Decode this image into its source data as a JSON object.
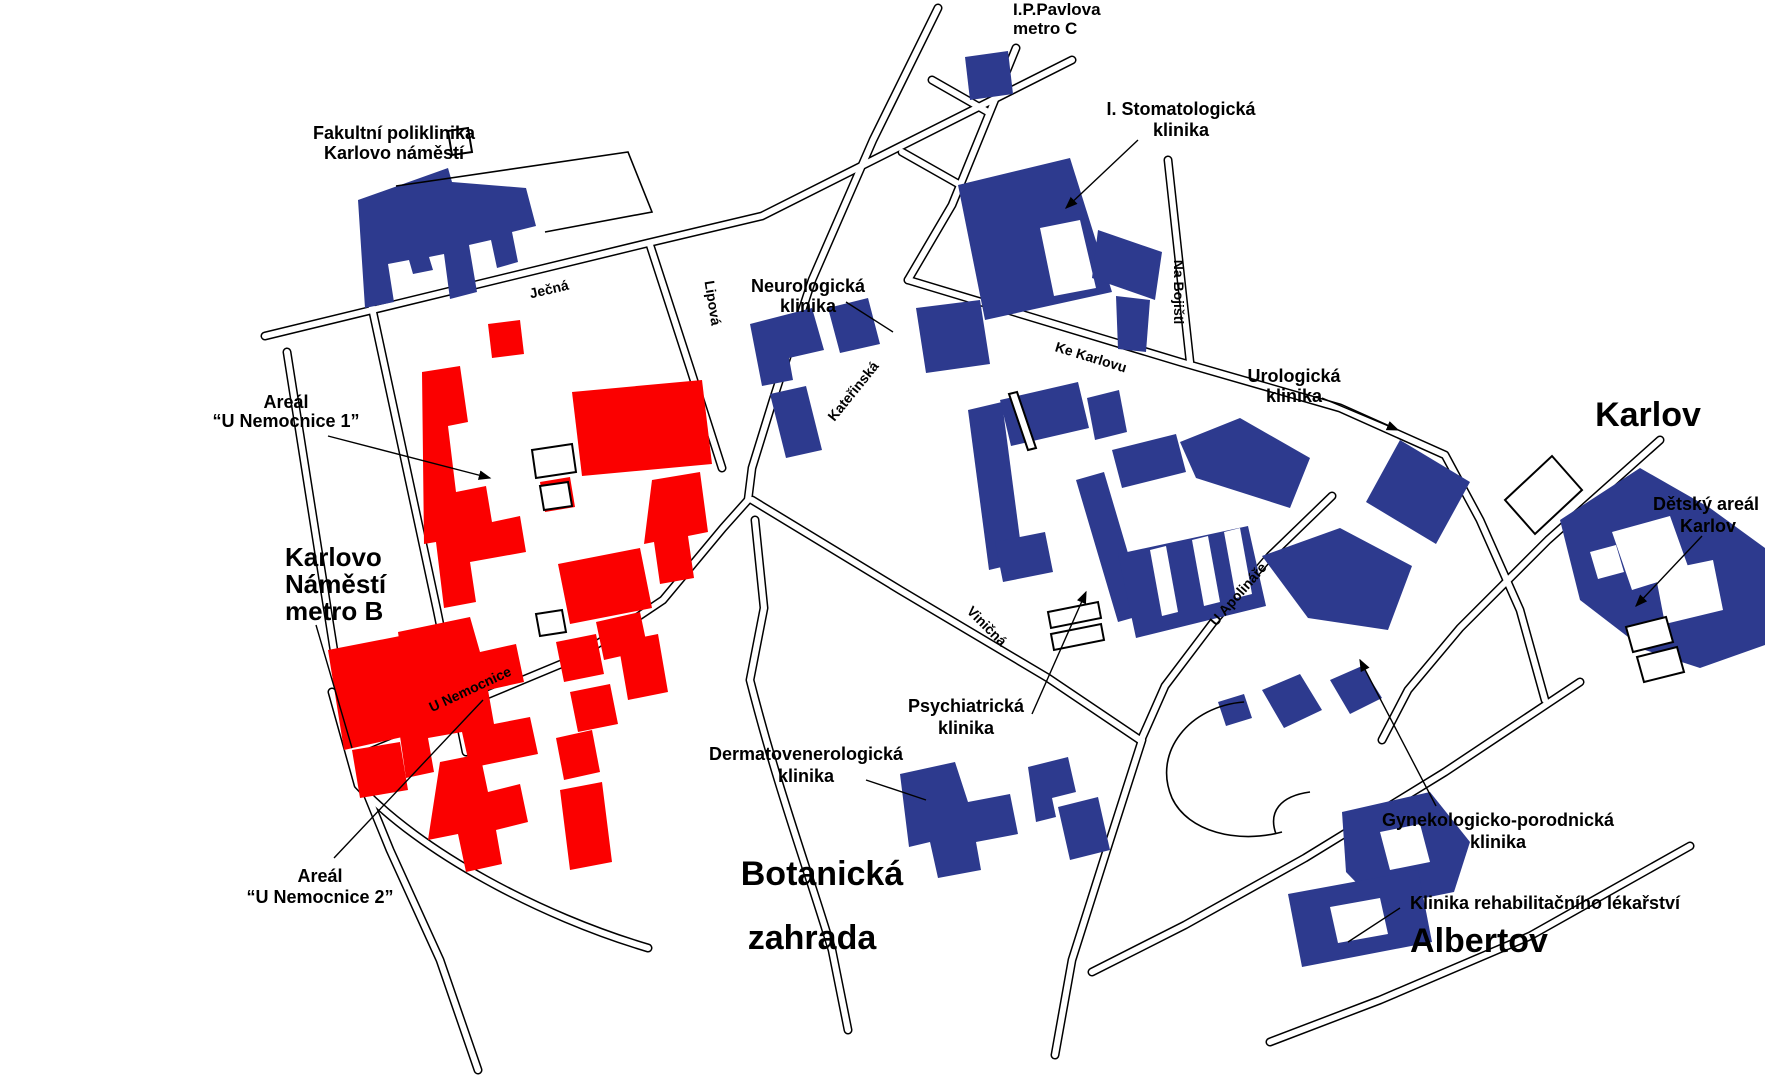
{
  "map": {
    "colors": {
      "building_blue": "#2d3a8e",
      "building_red": "#fb0000",
      "road_outline": "#000000",
      "background": "#ffffff"
    },
    "labels": {
      "ip_pavlova": {
        "line1": "I.P.Pavlova",
        "line2": "metro C"
      },
      "fakultni": {
        "line1": "Fakultní poliklinika",
        "line2": "Karlovo náměstí"
      },
      "stomatologicka": {
        "line1": "I. Stomatologická",
        "line2": "klinika"
      },
      "neurologicka": {
        "line1": "Neurologická",
        "line2": "klinika"
      },
      "urologicka": {
        "line1": "Urologická",
        "line2": "klinika"
      },
      "karlov": {
        "line1": "Karlov"
      },
      "detsky_areal": {
        "line1": "Dětský areál",
        "line2": "Karlov"
      },
      "areal1": {
        "line1": "Areál",
        "line2": "“U Nemocnice 1”"
      },
      "karlovo_namesti": {
        "line1": "Karlovo",
        "line2": "Náměstí",
        "line3": "metro B"
      },
      "psychiatricka": {
        "line1": "Psychiatrická",
        "line2": "klinika"
      },
      "dermatovenerologicka": {
        "line1": "Dermatovenerologická",
        "line2": "klinika"
      },
      "gynekologicko": {
        "line1": "Gynekologicko-porodnická",
        "line2": "klinika"
      },
      "rehabilitacni": {
        "line1": "Klinika rehabilitačního lékařství"
      },
      "botanicka": {
        "line1": "Botanická",
        "line2": "zahrada"
      },
      "albertov": {
        "line1": "Albertov"
      },
      "areal2": {
        "line1": "Areál",
        "line2": "“U Nemocnice 2”"
      }
    },
    "streets": {
      "jecna": "Ječná",
      "lipova": "Lipová",
      "katerinska": "Kateřinská",
      "ke_karlovu": "Ke Karlovu",
      "na_bojisti": "Na Bojišti",
      "vinicna": "Viničná",
      "u_apolinare": "U Apolináře",
      "u_nemocnice": "U Nemocnice"
    }
  }
}
